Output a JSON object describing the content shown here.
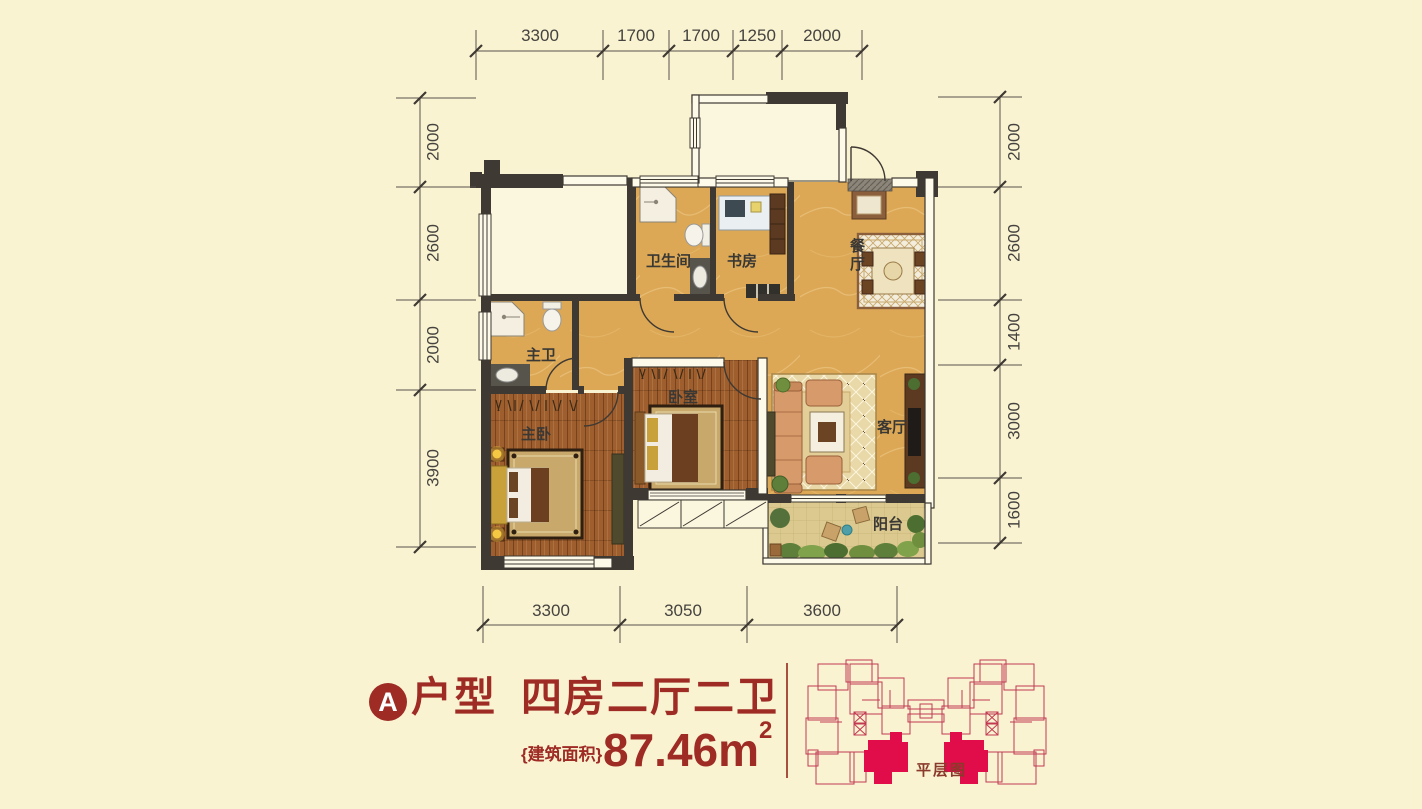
{
  "page": {
    "background": "#FAF3D2"
  },
  "title": {
    "type_letter": "A",
    "type_word": "户型",
    "layout_desc": "四房二厅二卫",
    "area_label": "{建筑面积}",
    "area_value": "87.46m",
    "area_exponent": "2",
    "accent_color": "#9E2B24"
  },
  "floor_plan": {
    "rooms": {
      "bathroom": "卫生间",
      "study": "书房",
      "dining": "餐厅",
      "master_bath": "主卫",
      "master_bedroom": "主卧",
      "bedroom": "卧室",
      "living": "客厅",
      "balcony": "阳台"
    },
    "dimensions_mm": {
      "top": [
        "3300",
        "1700",
        "1700",
        "1250",
        "2000"
      ],
      "bottom": [
        "3300",
        "3050",
        "3600"
      ],
      "left": [
        "2000",
        "2600",
        "2000",
        "3900"
      ],
      "right": [
        "2000",
        "2600",
        "1400",
        "3000",
        "1600"
      ]
    },
    "colors": {
      "wall": "#3E3933",
      "tile_floor": "#DCA855",
      "wood_floor": "#9E5E2E",
      "balcony_floor": "#DBC98F"
    }
  },
  "site_plan": {
    "label": "平层图",
    "outline_color": "#C13A52",
    "highlight_color": "#E00D4A"
  }
}
